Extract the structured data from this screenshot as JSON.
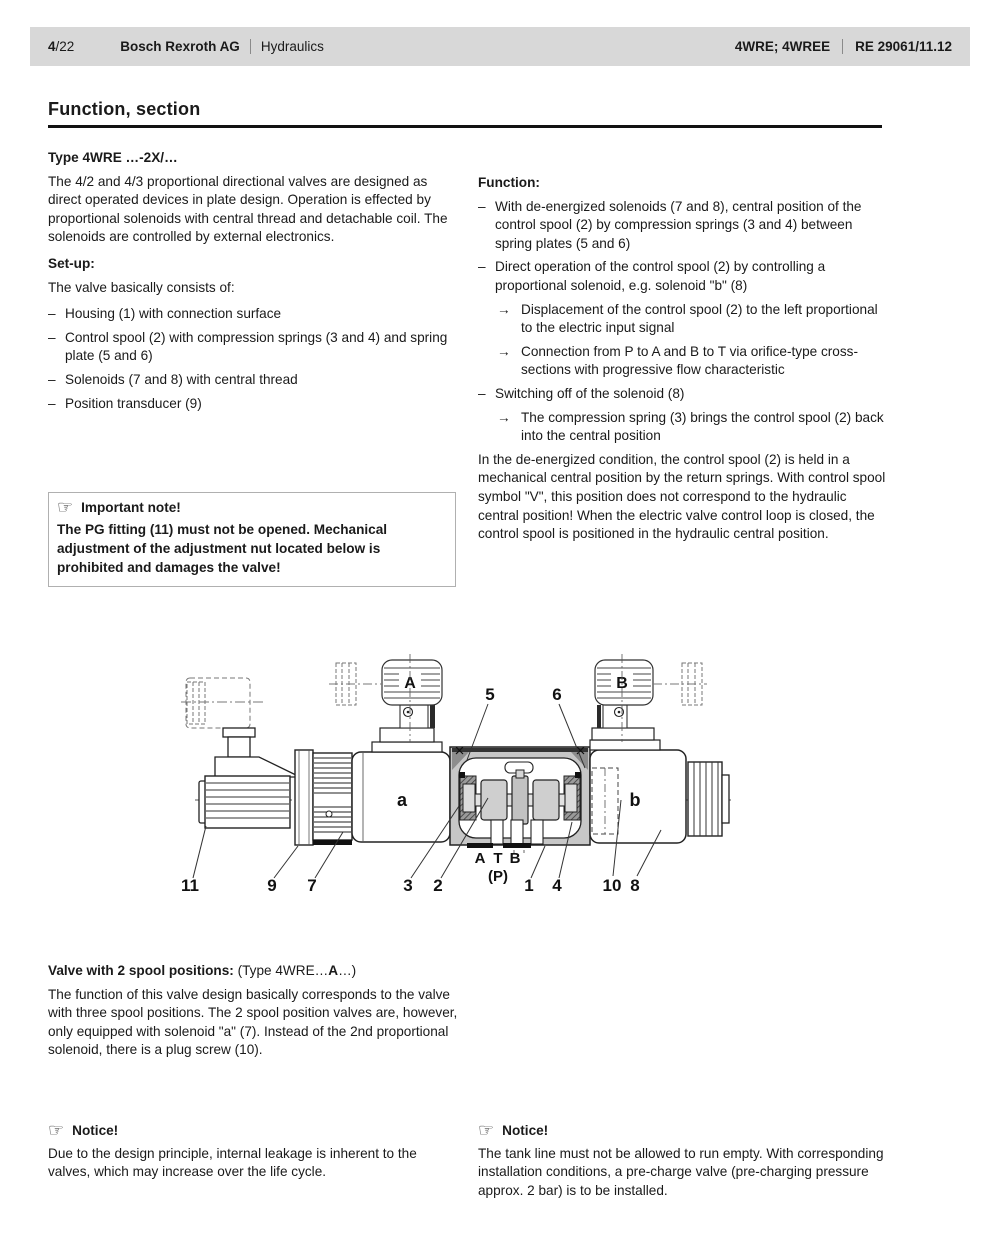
{
  "header": {
    "page": "4",
    "page_total": "/22",
    "company": "Bosch Rexroth AG",
    "division": "Hydraulics",
    "product": "4WRE; 4WREE",
    "doc_number": "RE 29061/11.12"
  },
  "title": "Function, section",
  "left": {
    "type_heading": "Type 4WRE …-2X/…",
    "intro": "The 4/2 and 4/3 proportional directional valves are designed as direct operated devices in plate design. Operation is effected by proportional solenoids with central thread and detachable coil. The solenoids are controlled by external electronics.",
    "setup_heading": "Set-up:",
    "setup_intro": "The valve basically consists of:",
    "items": [
      {
        "marker": "–",
        "text": "Housing (1) with connection surface"
      },
      {
        "marker": "–",
        "text": "Control spool (2) with compression springs (3 and 4) and spring plate (5 and 6)"
      },
      {
        "marker": "–",
        "text": "Solenoids (7 and 8) with central thread"
      },
      {
        "marker": "–",
        "text": "Position transducer (9)"
      }
    ],
    "note": {
      "icon": "☞",
      "title": "Important note!",
      "body": "The PG fitting (11) must not be opened. Mechanical adjustment of the adjustment nut located below is prohibited and damages the valve!"
    }
  },
  "right": {
    "function_heading": "Function:",
    "items": [
      {
        "marker": "–",
        "text": "With de-energized solenoids (7 and 8), central position of the control spool (2) by compression springs (3 and 4) between spring plates (5 and 6)"
      },
      {
        "marker": "–",
        "text": "Direct operation of the control spool (2) by controlling a proportional solenoid, e.g. solenoid \"b\" (8)"
      },
      {
        "marker": "→",
        "text": "Displacement of the control spool (2) to the left proportional to the electric input signal"
      },
      {
        "marker": "→",
        "text": "Connection from P to A and B to T via orifice-type cross-sections with progressive flow characteristic"
      },
      {
        "marker": "–",
        "text": "Switching off of the solenoid (8)"
      },
      {
        "marker": "→",
        "text": "The compression spring (3) brings the control spool (2) back into the central position"
      }
    ],
    "closing": "In the de-energized condition, the control spool (2) is held in a mechanical central position by the return springs. With control spool symbol \"V\", this position does not correspond to the hydraulic central position! When the electric valve control loop is closed, the control spool is positioned in the hydraulic central position."
  },
  "valve2": {
    "heading_bold": "Valve with 2 spool positions:",
    "heading_normal": " (Type 4WRE…",
    "heading_bold2": "A",
    "heading_end": "…)",
    "body": "The function of this valve design basically corresponds to the valve with three spool positions. The 2 spool position valves are, however, only equipped with solenoid \"a\" (7). Instead of the 2nd proportional solenoid, there is a plug screw (10)."
  },
  "notices": [
    {
      "icon": "☞",
      "title": "Notice!",
      "body": "Due to the design principle, internal leakage is inherent to the valves, which may increase over the life cycle."
    },
    {
      "icon": "☞",
      "title": "Notice!",
      "body": "The tank line must not be allowed to run empty. With corresponding installation conditions, a pre-charge valve (pre-charging pressure approx. 2 bar) is to be installed."
    }
  ],
  "diagram": {
    "labels": {
      "connector_a": "A",
      "connector_b": "B",
      "solenoid_a": "a",
      "solenoid_b": "b",
      "port_a": "A",
      "port_t": "T",
      "port_b": "B",
      "port_p": "(P)"
    },
    "callouts": {
      "c1": "1",
      "c2": "2",
      "c3": "3",
      "c4": "4",
      "c5": "5",
      "c6": "6",
      "c7": "7",
      "c8": "8",
      "c9": "9",
      "c10": "10",
      "c11": "11"
    }
  },
  "colors": {
    "header_bg": "#d8d8d8",
    "housing_fill": "#c7c7c7",
    "text": "#1a1a1a"
  }
}
